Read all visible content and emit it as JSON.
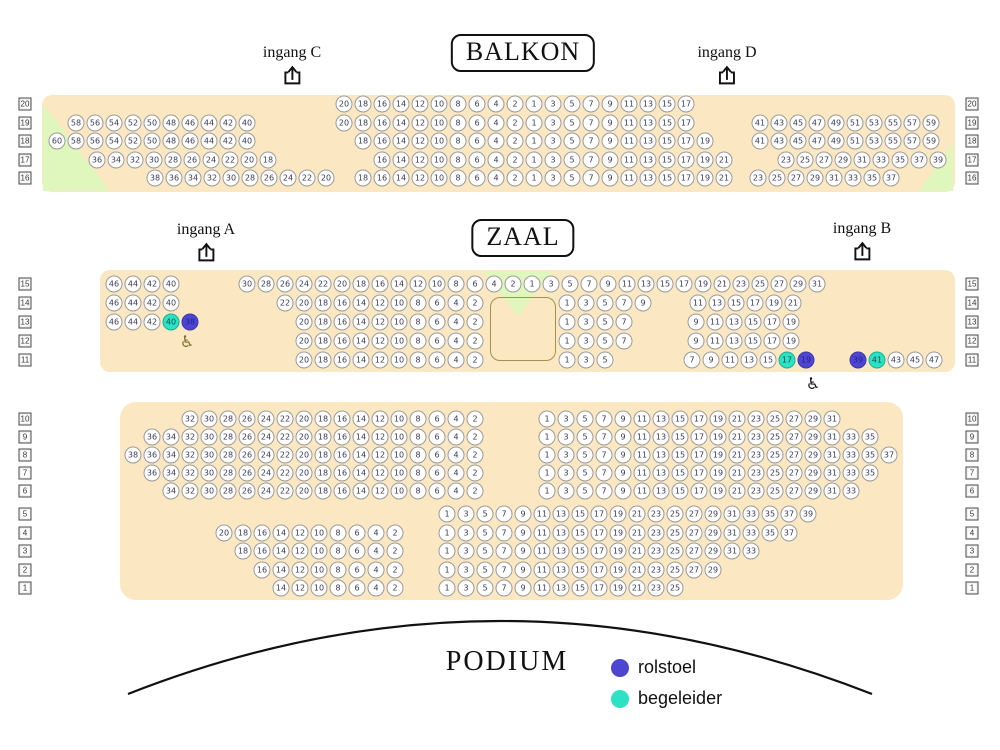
{
  "titles": {
    "balkon": "BALKON",
    "zaal": "ZAAL",
    "podium": "PODIUM"
  },
  "colors": {
    "panel": "#fbe7c1",
    "green_area": "#dff6bd",
    "rolstoel": "#4e46d0",
    "begeleider": "#2be2c4",
    "seat_fill": "#ffffff",
    "seat_border": "#9a9a9a",
    "seat_text": "#3a3a55",
    "stage_line": "#111111",
    "wheelchair_icon_left": "#7d6e2e",
    "wheelchair_icon_right": "#111111"
  },
  "icons": {
    "wheelchair_glyph": "♿"
  },
  "entrances": [
    {
      "id": "entrance-c",
      "label": "ingang C",
      "x": 292,
      "y": 44
    },
    {
      "id": "entrance-d",
      "label": "ingang D",
      "x": 727,
      "y": 44
    },
    {
      "id": "entrance-a",
      "label": "ingang A",
      "x": 206,
      "y": 221
    },
    {
      "id": "entrance-b",
      "label": "ingang B",
      "x": 862,
      "y": 220
    }
  ],
  "legend": {
    "items": [
      {
        "label": "rolstoel",
        "color": "#4e46d0"
      },
      {
        "label": "begeleider",
        "color": "#2be2c4"
      }
    ]
  },
  "wheelchair_icons": [
    {
      "x": 187,
      "y": 342,
      "color": "#7d6e2e"
    },
    {
      "x": 813,
      "y": 384,
      "color": "#111111"
    }
  ],
  "row_labels": {
    "left_x": 25,
    "right_x": 972,
    "rows": [
      {
        "n": "20",
        "y": 104
      },
      {
        "n": "19",
        "y": 123
      },
      {
        "n": "18",
        "y": 141
      },
      {
        "n": "17",
        "y": 160
      },
      {
        "n": "16",
        "y": 178
      },
      {
        "n": "15",
        "y": 284
      },
      {
        "n": "14",
        "y": 303
      },
      {
        "n": "13",
        "y": 322
      },
      {
        "n": "12",
        "y": 341
      },
      {
        "n": "11",
        "y": 360
      },
      {
        "n": "10",
        "y": 419
      },
      {
        "n": "9",
        "y": 437
      },
      {
        "n": "8",
        "y": 455
      },
      {
        "n": "7",
        "y": 473
      },
      {
        "n": "6",
        "y": 491
      },
      {
        "n": "5",
        "y": 514
      },
      {
        "n": "4",
        "y": 533
      },
      {
        "n": "3",
        "y": 551
      },
      {
        "n": "2",
        "y": 570
      },
      {
        "n": "1",
        "y": 588
      }
    ]
  },
  "seat_pitch": 19,
  "seat_groups": [
    {
      "section": "balkon",
      "row": "20",
      "y": 104,
      "x": 344,
      "seats": [
        20,
        18,
        16,
        14,
        12,
        10,
        8,
        6,
        4,
        2,
        1,
        3,
        5,
        7,
        9,
        11,
        13,
        15,
        17
      ]
    },
    {
      "section": "balkon",
      "row": "19",
      "y": 123,
      "x": 76,
      "seats": [
        58,
        56,
        54,
        52,
        50,
        48,
        46,
        44,
        42,
        40
      ]
    },
    {
      "section": "balkon",
      "row": "19",
      "y": 123,
      "x": 344,
      "seats": [
        20,
        18,
        16,
        14,
        12,
        10,
        8,
        6,
        4,
        2,
        1,
        3,
        5,
        7,
        9,
        11,
        13,
        15,
        17
      ]
    },
    {
      "section": "balkon",
      "row": "19",
      "y": 123,
      "x": 760,
      "seats": [
        41,
        43,
        45,
        47,
        49,
        51,
        53,
        55,
        57,
        59
      ]
    },
    {
      "section": "balkon",
      "row": "18",
      "y": 141,
      "x": 57,
      "seats": [
        60,
        58,
        56,
        54,
        52,
        50,
        48,
        46,
        44,
        42,
        40
      ]
    },
    {
      "section": "balkon",
      "row": "18",
      "y": 141,
      "x": 363,
      "seats": [
        18,
        16,
        14,
        12,
        10,
        8,
        6,
        4,
        2,
        1,
        3,
        5,
        7,
        9,
        11,
        13,
        15,
        17,
        19
      ]
    },
    {
      "section": "balkon",
      "row": "18",
      "y": 141,
      "x": 760,
      "seats": [
        41,
        43,
        45,
        47,
        49,
        51,
        53,
        55,
        57,
        59
      ]
    },
    {
      "section": "balkon",
      "row": "17",
      "y": 160,
      "x": 97,
      "seats": [
        36,
        34,
        32,
        30,
        28,
        26,
        24,
        22,
        20,
        18
      ]
    },
    {
      "section": "balkon",
      "row": "17",
      "y": 160,
      "x": 382,
      "seats": [
        16,
        14,
        12,
        10,
        8,
        6,
        4,
        2,
        1,
        3,
        5,
        7,
        9,
        11,
        13,
        15,
        17,
        19,
        21
      ]
    },
    {
      "section": "balkon",
      "row": "17",
      "y": 160,
      "x": 786,
      "seats": [
        23,
        25,
        27,
        29,
        31,
        33,
        35,
        37,
        39
      ]
    },
    {
      "section": "balkon",
      "row": "16",
      "y": 178,
      "x": 155,
      "seats": [
        38,
        36,
        34,
        32,
        30,
        28,
        26,
        24,
        22,
        20
      ]
    },
    {
      "section": "balkon",
      "row": "16",
      "y": 178,
      "x": 363,
      "seats": [
        18,
        16,
        14,
        12,
        10,
        8,
        6,
        4,
        2,
        1,
        3,
        5,
        7,
        9,
        11,
        13,
        15,
        17,
        19,
        21
      ]
    },
    {
      "section": "balkon",
      "row": "16",
      "y": 178,
      "x": 758,
      "seats": [
        23,
        25,
        27,
        29,
        31,
        33,
        35,
        37
      ]
    },
    {
      "section": "zaal",
      "row": "15",
      "y": 284,
      "x": 114,
      "seats": [
        46,
        44,
        42,
        40
      ]
    },
    {
      "section": "zaal",
      "row": "15",
      "y": 284,
      "x": 247,
      "seats": [
        30,
        28,
        26,
        24,
        22,
        20,
        18,
        16,
        14,
        12,
        10,
        8,
        6,
        4,
        2,
        1,
        3,
        5,
        7,
        9,
        11,
        13,
        15,
        17,
        19,
        21,
        23,
        25,
        27,
        29,
        31
      ]
    },
    {
      "section": "zaal",
      "row": "14",
      "y": 303,
      "x": 114,
      "seats": [
        46,
        44,
        42,
        40
      ]
    },
    {
      "section": "zaal",
      "row": "14",
      "y": 303,
      "x": 285,
      "seats": [
        22,
        20,
        18,
        16,
        14,
        12,
        10,
        8,
        6,
        4,
        2
      ]
    },
    {
      "section": "zaal",
      "row": "14",
      "y": 303,
      "x": 567,
      "seats": [
        1,
        3,
        5,
        7,
        9
      ]
    },
    {
      "section": "zaal",
      "row": "14",
      "y": 303,
      "x": 698,
      "seats": [
        11,
        13,
        15,
        17,
        19,
        21
      ]
    },
    {
      "section": "zaal",
      "row": "13",
      "y": 322,
      "x": 114,
      "seats": [
        46,
        44,
        42,
        {
          "n": 40,
          "t": "begeleider"
        },
        {
          "n": 38,
          "t": "rolstoel"
        }
      ]
    },
    {
      "section": "zaal",
      "row": "13",
      "y": 322,
      "x": 304,
      "seats": [
        20,
        18,
        16,
        14,
        12,
        10,
        8,
        6,
        4,
        2
      ]
    },
    {
      "section": "zaal",
      "row": "13",
      "y": 322,
      "x": 567,
      "seats": [
        1,
        3,
        5,
        7
      ]
    },
    {
      "section": "zaal",
      "row": "13",
      "y": 322,
      "x": 696,
      "seats": [
        9,
        11,
        13,
        15,
        17,
        19
      ]
    },
    {
      "section": "zaal",
      "row": "12",
      "y": 341,
      "x": 304,
      "seats": [
        20,
        18,
        16,
        14,
        12,
        10,
        8,
        6,
        4,
        2
      ]
    },
    {
      "section": "zaal",
      "row": "12",
      "y": 341,
      "x": 567,
      "seats": [
        1,
        3,
        5,
        7
      ]
    },
    {
      "section": "zaal",
      "row": "12",
      "y": 341,
      "x": 696,
      "seats": [
        9,
        11,
        13,
        15,
        17,
        19
      ]
    },
    {
      "section": "zaal",
      "row": "11",
      "y": 360,
      "x": 304,
      "seats": [
        20,
        18,
        16,
        14,
        12,
        10,
        8,
        6,
        4,
        2
      ]
    },
    {
      "section": "zaal",
      "row": "11",
      "y": 360,
      "x": 567,
      "seats": [
        1,
        3,
        5
      ]
    },
    {
      "section": "zaal",
      "row": "11",
      "y": 360,
      "x": 692,
      "seats": [
        7,
        9,
        11,
        13,
        15,
        {
          "n": 17,
          "t": "begeleider"
        },
        {
          "n": 19,
          "t": "rolstoel"
        }
      ]
    },
    {
      "section": "zaal",
      "row": "11",
      "y": 360,
      "x": 858,
      "seats": [
        {
          "n": 39,
          "t": "rolstoel"
        },
        {
          "n": 41,
          "t": "begeleider"
        },
        43,
        45,
        47
      ]
    },
    {
      "section": "zaal-voor",
      "row": "10",
      "y": 419,
      "x": 190,
      "seats": [
        32,
        30,
        28,
        26,
        24,
        22,
        20,
        18,
        16,
        14,
        12,
        10,
        8,
        6,
        4,
        2
      ]
    },
    {
      "section": "zaal-voor",
      "row": "10",
      "y": 419,
      "x": 547,
      "seats": [
        1,
        3,
        5,
        7,
        9,
        11,
        13,
        15,
        17,
        19,
        21,
        23,
        25,
        27,
        29,
        31
      ]
    },
    {
      "section": "zaal-voor",
      "row": "9",
      "y": 437,
      "x": 152,
      "seats": [
        36,
        34,
        32,
        30,
        28,
        26,
        24,
        22,
        20,
        18,
        16,
        14,
        12,
        10,
        8,
        6,
        4,
        2
      ]
    },
    {
      "section": "zaal-voor",
      "row": "9",
      "y": 437,
      "x": 547,
      "seats": [
        1,
        3,
        5,
        7,
        9,
        11,
        13,
        15,
        17,
        19,
        21,
        23,
        25,
        27,
        29,
        31,
        33,
        35
      ]
    },
    {
      "section": "zaal-voor",
      "row": "8",
      "y": 455,
      "x": 133,
      "seats": [
        38,
        36,
        34,
        32,
        30,
        28,
        26,
        24,
        22,
        20,
        18,
        16,
        14,
        12,
        10,
        8,
        6,
        4,
        2
      ]
    },
    {
      "section": "zaal-voor",
      "row": "8",
      "y": 455,
      "x": 547,
      "seats": [
        1,
        3,
        5,
        7,
        9,
        11,
        13,
        15,
        17,
        19,
        21,
        23,
        25,
        27,
        29,
        31,
        33,
        35,
        37
      ]
    },
    {
      "section": "zaal-voor",
      "row": "7",
      "y": 473,
      "x": 152,
      "seats": [
        36,
        34,
        32,
        30,
        28,
        26,
        24,
        22,
        20,
        18,
        16,
        14,
        12,
        10,
        8,
        6,
        4,
        2
      ]
    },
    {
      "section": "zaal-voor",
      "row": "7",
      "y": 473,
      "x": 547,
      "seats": [
        1,
        3,
        5,
        7,
        9,
        11,
        13,
        15,
        17,
        19,
        21,
        23,
        25,
        27,
        29,
        31,
        33,
        35
      ]
    },
    {
      "section": "zaal-voor",
      "row": "6",
      "y": 491,
      "x": 171,
      "seats": [
        34,
        32,
        30,
        28,
        26,
        24,
        22,
        20,
        18,
        16,
        14,
        12,
        10,
        8,
        6,
        4,
        2
      ]
    },
    {
      "section": "zaal-voor",
      "row": "6",
      "y": 491,
      "x": 547,
      "seats": [
        1,
        3,
        5,
        7,
        9,
        11,
        13,
        15,
        17,
        19,
        21,
        23,
        25,
        27,
        29,
        31,
        33
      ]
    },
    {
      "section": "zaal-voor",
      "row": "5",
      "y": 514,
      "x": 447,
      "seats": [
        1,
        3,
        5,
        7,
        9,
        11,
        13,
        15,
        17,
        19,
        21,
        23,
        25,
        27,
        29,
        31,
        33,
        35,
        37,
        39
      ]
    },
    {
      "section": "zaal-voor",
      "row": "4",
      "y": 533,
      "x": 224,
      "seats": [
        20,
        18,
        16,
        14,
        12,
        10,
        8,
        6,
        4,
        2
      ]
    },
    {
      "section": "zaal-voor",
      "row": "4",
      "y": 533,
      "x": 447,
      "seats": [
        1,
        3,
        5,
        7,
        9,
        11,
        13,
        15,
        17,
        19,
        21,
        23,
        25,
        27,
        29,
        31,
        33,
        35,
        37
      ]
    },
    {
      "section": "zaal-voor",
      "row": "3",
      "y": 551,
      "x": 243,
      "seats": [
        18,
        16,
        14,
        12,
        10,
        8,
        6,
        4,
        2
      ]
    },
    {
      "section": "zaal-voor",
      "row": "3",
      "y": 551,
      "x": 447,
      "seats": [
        1,
        3,
        5,
        7,
        9,
        11,
        13,
        15,
        17,
        19,
        21,
        23,
        25,
        27,
        29,
        31,
        33
      ]
    },
    {
      "section": "zaal-voor",
      "row": "2",
      "y": 570,
      "x": 262,
      "seats": [
        16,
        14,
        12,
        10,
        8,
        6,
        4,
        2
      ]
    },
    {
      "section": "zaal-voor",
      "row": "2",
      "y": 570,
      "x": 447,
      "seats": [
        1,
        3,
        5,
        7,
        9,
        11,
        13,
        15,
        17,
        19,
        21,
        23,
        25,
        27,
        29
      ]
    },
    {
      "section": "zaal-voor",
      "row": "1",
      "y": 588,
      "x": 281,
      "seats": [
        14,
        12,
        10,
        8,
        6,
        4,
        2
      ]
    },
    {
      "section": "zaal-voor",
      "row": "1",
      "y": 588,
      "x": 447,
      "seats": [
        1,
        3,
        5,
        7,
        9,
        11,
        13,
        15,
        17,
        19,
        21,
        23,
        25
      ]
    }
  ]
}
